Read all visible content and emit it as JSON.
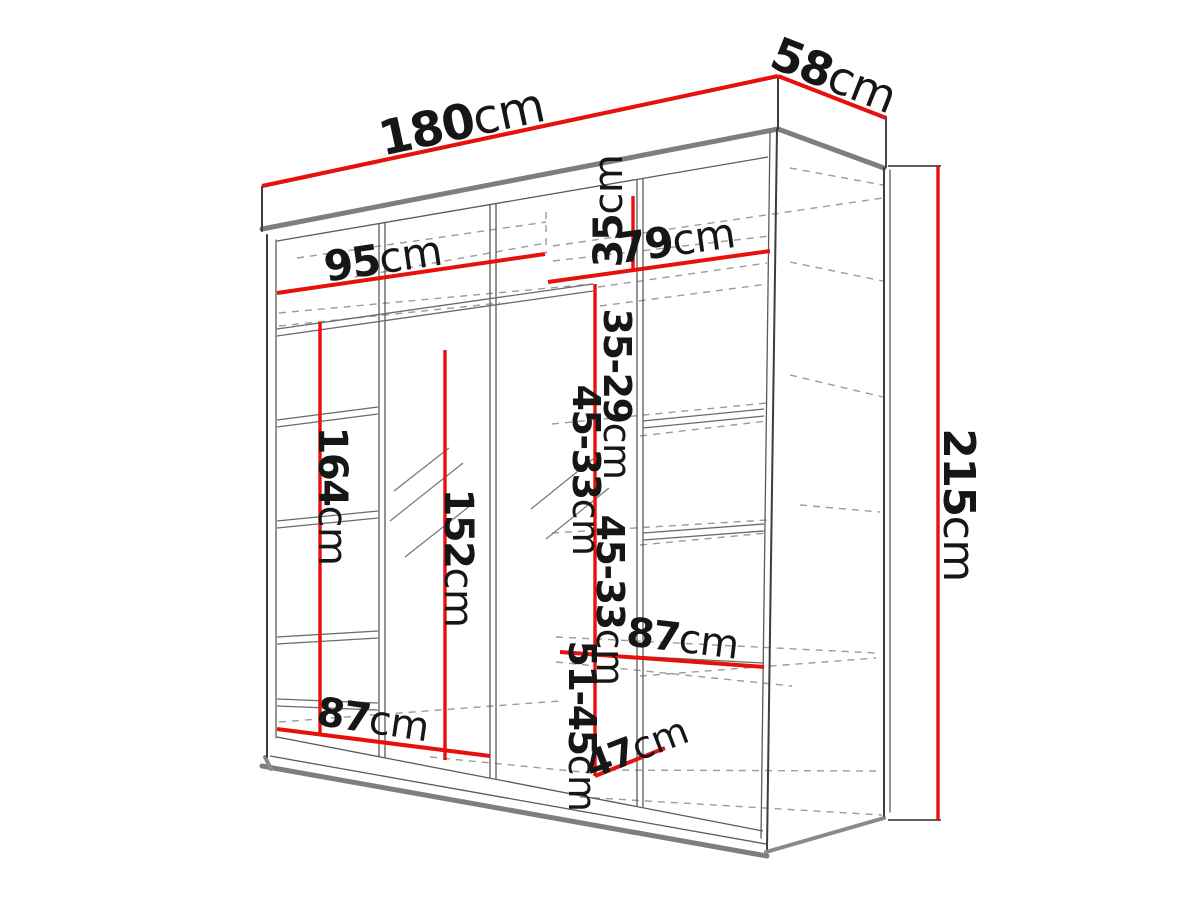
{
  "page": {
    "description": "Technical dimension drawing of a three-door sliding wardrobe with mirror, shown in perspective with interior shelf layout",
    "background": "#ffffff"
  },
  "colors": {
    "dimension_red": "#e8100c",
    "outline_dark": "#3d3d3d",
    "structure_gray": "#7e7e7e",
    "dashed_gray": "#9b9b9b",
    "label_text": "#161616"
  },
  "dimensions": {
    "total_width": {
      "num": "180",
      "unit": "cm"
    },
    "total_depth": {
      "num": "58",
      "unit": "cm"
    },
    "total_height": {
      "num": "215",
      "unit": "cm"
    },
    "left_section_width": {
      "num": "95",
      "unit": "cm"
    },
    "right_section_width": {
      "num": "79",
      "unit": "cm"
    },
    "top_shelf_gap": {
      "num": "35",
      "unit": "cm"
    },
    "second_shelf_gap": {
      "num": "35-29",
      "unit": "cm"
    },
    "third_shelf_gap": {
      "num": "45-33",
      "unit": "cm"
    },
    "fourth_shelf_gap": {
      "num": "45-33",
      "unit": "cm"
    },
    "bottom_shelf_gap": {
      "num": "51-45",
      "unit": "cm"
    },
    "hanging_height": {
      "num": "164",
      "unit": "cm"
    },
    "mirror_height": {
      "num": "152",
      "unit": "cm"
    },
    "middle_shelf_width": {
      "num": "87",
      "unit": "cm"
    },
    "bottom_shelf_width": {
      "num": "87",
      "unit": "cm"
    },
    "shelf_depth": {
      "num": "47",
      "unit": "cm"
    }
  }
}
